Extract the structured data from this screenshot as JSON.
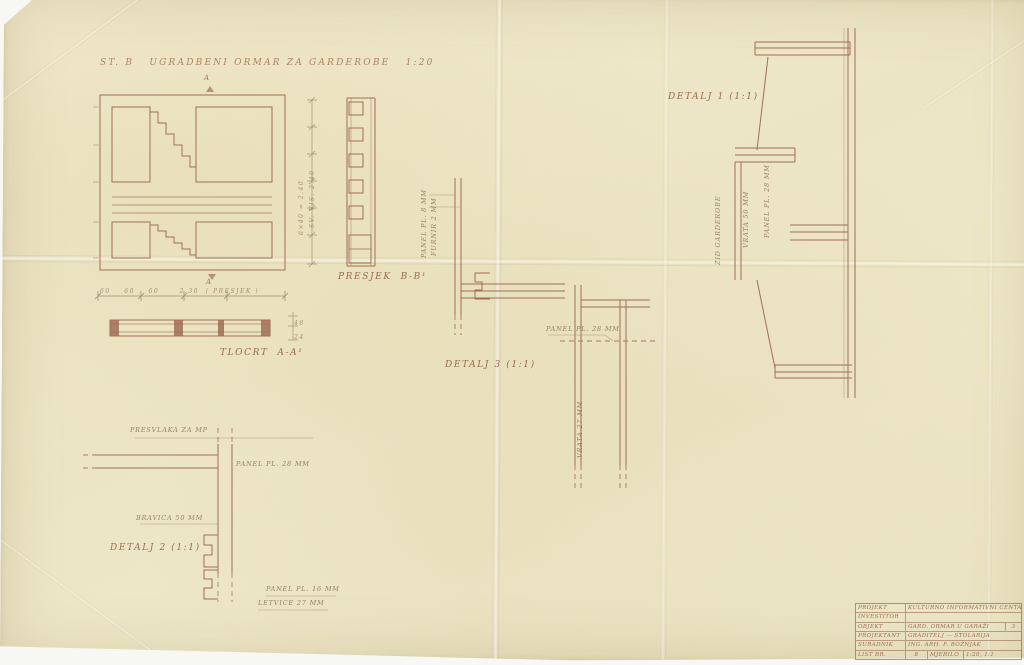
{
  "meta": {
    "paper_color": "#eee8c9",
    "ink_color": "#a06e56",
    "pencil_color": "#998668"
  },
  "titles": {
    "main": "ST. B   UGRADBENI ORMAR ZA GARDEROBE   1:20",
    "detail1": "DETALJ 1 (1:1)",
    "detail2": "DETALJ 2 (1:1)",
    "detail3": "DETALJ 3 (1:1)",
    "section_plan": "TLOCRT  A-A¹",
    "section_vert": "PRESJEK  B-B¹"
  },
  "markers": {
    "section_top": "A",
    "section_bottom": "A"
  },
  "dimensions": {
    "plan_row": "60    60    60      2.30  ( PRESJEK )",
    "height_left": "6×40 = 2.40",
    "height_right": "SV. VIS. 2.40",
    "strip_right_top": "48",
    "strip_right_bottom": "24"
  },
  "annotations": {
    "d3_v1": "PANEL PL. 8 MM",
    "d3_v2": "FURNIR 2 MM",
    "d3_panel28": "PANEL PL. 28 MM",
    "d3_vrata": "VRATA 27 MM",
    "d1_v1": "ZID GARDEROBE",
    "d1_v2": "VRATA 50 MM",
    "d1_v3": "PANEL PL. 28 MM",
    "d2_presvlaka": "PRESVLAKA ZA MP",
    "d2_panel28": "PANEL PL. 28 MM",
    "d2_bravica": "BRAVICA 50 MM",
    "d2_panel16": "PANEL PL. 16 MM",
    "d2_letvice": "LETVICE 27 MM"
  },
  "title_block": {
    "rows": [
      {
        "label": "PROJEKT",
        "value": "KULTURNO INFORMATIVNI CENTAR"
      },
      {
        "label": "INVESTITOR",
        "value": ""
      },
      {
        "label": "OBJEKT",
        "value": "GARD. ORMAR U GARAŽI",
        "num": "3"
      },
      {
        "label": "PROJEKTANT",
        "value": "GRADITELJ — STOLARIJA"
      },
      {
        "label": "SURADNIK",
        "value": "ING. ARH. F. BOŽNJAK"
      },
      {
        "label": "LIST BR.",
        "value": "8",
        "label2": "MJERILO",
        "value2": "1:20, 1:1"
      }
    ]
  }
}
